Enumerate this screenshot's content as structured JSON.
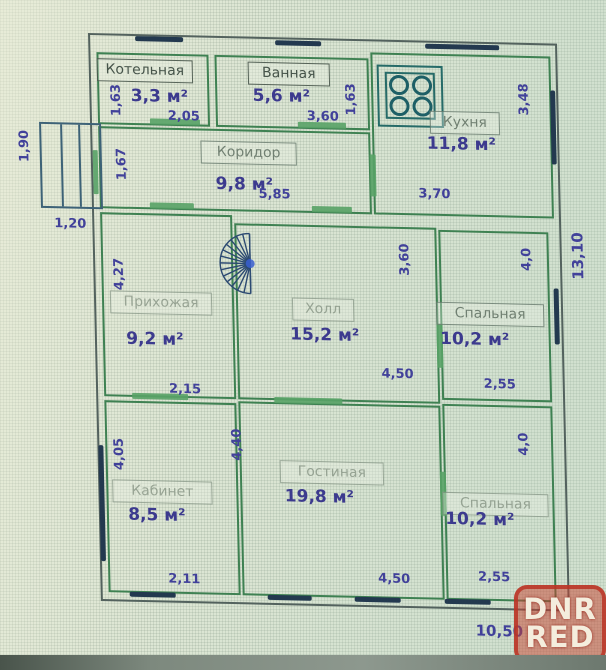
{
  "plan": {
    "rooms": [
      {
        "name": "Котельная",
        "area": "3,3 м²",
        "dim_left": "1,63",
        "dim_bottom": "2,05"
      },
      {
        "name": "Ванная",
        "area": "5,6 м²",
        "dim_bottom": "3,60",
        "dim_right": "1,63"
      },
      {
        "name": "Кухня",
        "area": "11,8 м²",
        "dim_right": "3,48",
        "dim_bottom": "3,70"
      },
      {
        "name": "Коридор",
        "area": "9,8 м²",
        "dim_left": "1,67",
        "dim_bottom": "5,85"
      },
      {
        "name": "Прихожая",
        "area": "9,2 м²",
        "dim_left": "4,27",
        "dim_bottom": "2,15"
      },
      {
        "name": "Холл",
        "area": "15,2 м²",
        "dim_right": "3,60",
        "dim_bottom": "4,50"
      },
      {
        "name": "Спальная",
        "area": "10,2 м²",
        "dim_right": "4,0",
        "dim_bottom": "2,55"
      },
      {
        "name": "Кабинет",
        "area": "8,5 м²",
        "dim_left": "4,05",
        "dim_bottom": "2,11"
      },
      {
        "name": "Гостиная",
        "area": "19,8 м²",
        "dim_left": "4,40",
        "dim_bottom": "4,50"
      },
      {
        "name": "Спальная",
        "area": "10,2 м²",
        "dim_right": "4,0",
        "dim_bottom": "2,55"
      }
    ],
    "outside": {
      "total_height": "13,10",
      "total_width": "10,50",
      "porch_depth": "1,90",
      "porch_width": "1,20"
    },
    "icons": {
      "stove": "stove-icon",
      "stairs": "spiral-staircase-icon",
      "window": "window-marker",
      "door": "door-marker"
    },
    "colors": {
      "wall_green": "#3e8152",
      "wall_outer": "#53625e",
      "window_navy": "#23394f",
      "door_green": "#58a266",
      "dim_text": "#41419a",
      "label_text": "#46544a",
      "background": "#dde6d4",
      "watermark_red": "#c74634"
    }
  },
  "watermark": {
    "line1": "DNR",
    "line2": "RED"
  }
}
